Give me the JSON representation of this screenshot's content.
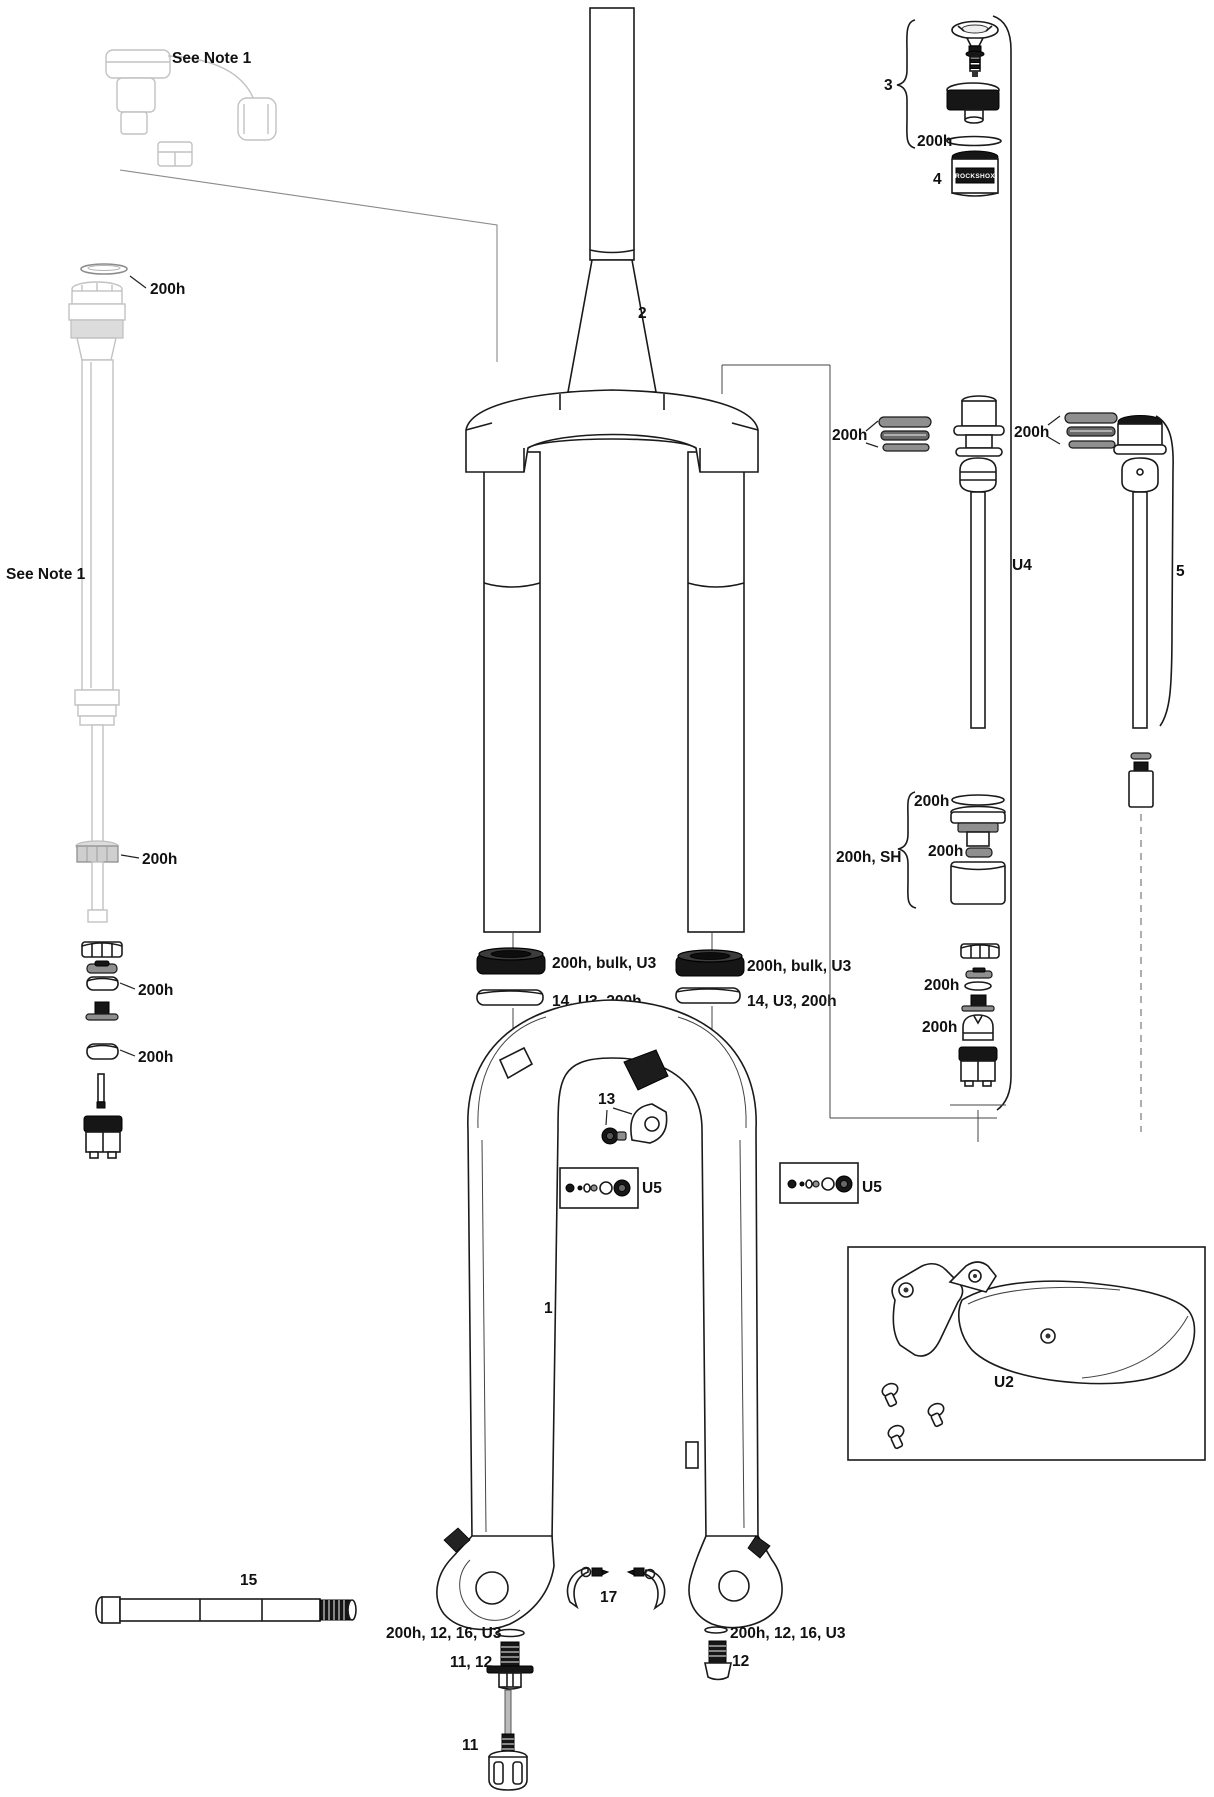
{
  "figure": {
    "kind": "exploded-parts-diagram",
    "subject": "suspension-fork-service-parts"
  },
  "labels": {
    "note_top": "See Note 1",
    "note_left": "See Note 1",
    "upper_oring": "200h",
    "damper_adjuster": "200h",
    "left_seal_ring_upper": "200h",
    "left_seal_ring_lower": "200h",
    "steerer": "2",
    "group_air_top": "3",
    "air_top_oring": "200h",
    "air_top_cap": "4",
    "part4_logo": "ROCKSHOX",
    "air_glide_rings": "200h",
    "damper_glide_rings": "200h",
    "air_shaft_group": "U4",
    "damper_shaft_group": "5",
    "seal_head_oring": "200h",
    "seal_head_group": "200h, SH",
    "seal_head_washer": "200h",
    "reb_oring": "200h",
    "reb_detent": "200h",
    "dust_seal_left": "200h, bulk, U3",
    "foam_ring_left": "14, U3, 200h",
    "dust_seal_right": "200h, bulk, U3",
    "foam_ring_right": "14, U3, 200h",
    "fender_bolt": "13",
    "shim_kit_left": "U5",
    "shim_kit_right": "U5",
    "lower_leg": "1",
    "fender_kit": "U2",
    "axle": "15",
    "hose_guide": "17",
    "foot_bolt_left_group": "200h, 12, 16, U3",
    "foot_bolt_left": "11, 12",
    "foot_bolt_right_group": "200h, 12, 16, U3",
    "foot_bolt_right": "12",
    "rebound_knob": "11"
  }
}
